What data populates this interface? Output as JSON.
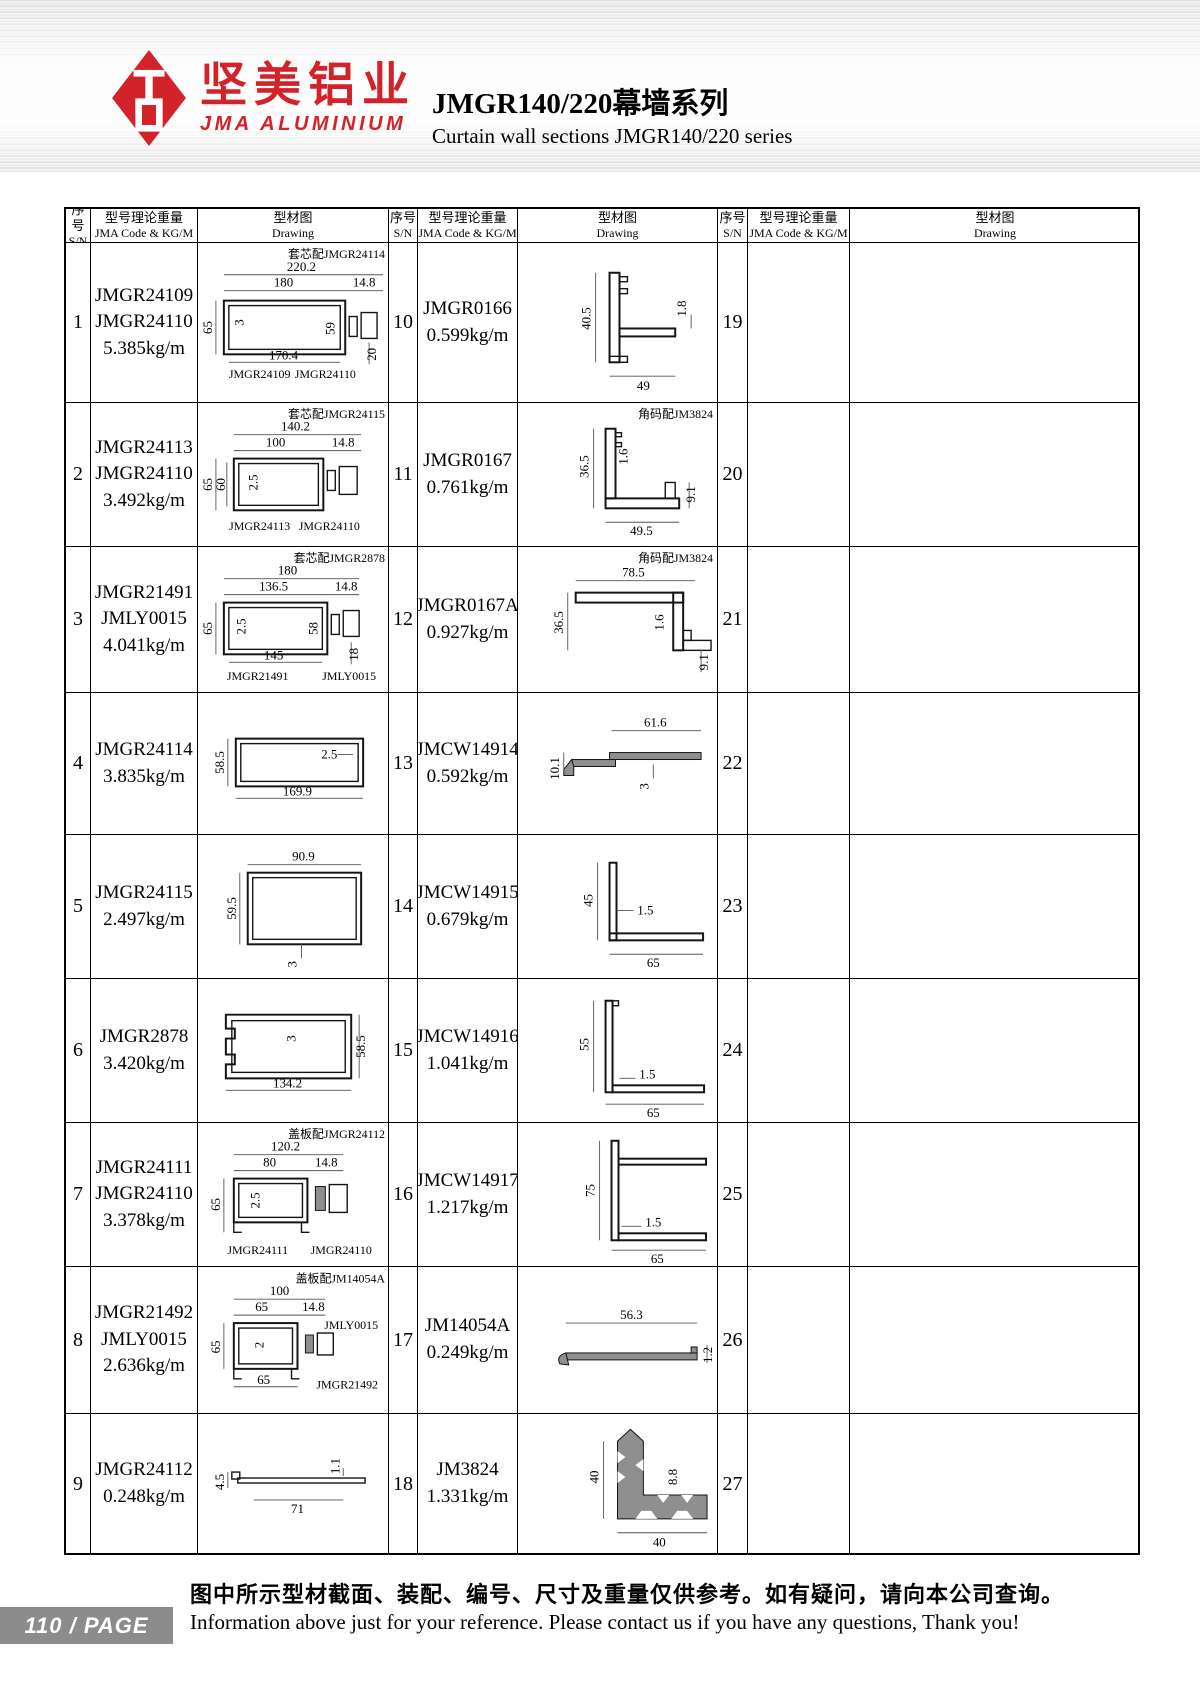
{
  "header": {
    "logo_cn": "坚美铝业",
    "logo_en": "JMA ALUMINIUM",
    "brand_red": "#d2232a",
    "title_cn": "JMGR140/220幕墙系列",
    "title_en": "Curtain wall sections JMGR140/220 series"
  },
  "table_headers": {
    "sn_cn": "序号",
    "sn_en": "S/N",
    "code_cn": "型号理论重量",
    "code_en": "JMA Code & KG/M",
    "drawing_cn": "型材图",
    "drawing_en": "Drawing"
  },
  "col1": [
    {
      "sn": "1",
      "lines": [
        "JMGR24109",
        "JMGR24110",
        "5.385kg/m"
      ],
      "drawing": {
        "assembly": "套芯配JMGR24114",
        "dims": [
          "220.2",
          "180",
          "14.8",
          "65",
          "3",
          "59",
          "170.4",
          "20"
        ],
        "labels": [
          "JMGR24109",
          "JMGR24110"
        ]
      }
    },
    {
      "sn": "2",
      "lines": [
        "JMGR24113",
        "JMGR24110",
        "3.492kg/m"
      ],
      "drawing": {
        "assembly": "套芯配JMGR24115",
        "dims": [
          "140.2",
          "100",
          "14.8",
          "65",
          "60",
          "2.5"
        ],
        "labels": [
          "JMGR24113",
          "JMGR24110"
        ]
      }
    },
    {
      "sn": "3",
      "lines": [
        "JMGR21491",
        "JMLY0015",
        "4.041kg/m"
      ],
      "drawing": {
        "assembly": "套芯配JMGR2878",
        "dims": [
          "180",
          "136.5",
          "14.8",
          "65",
          "2.5",
          "58",
          "145",
          "18"
        ],
        "labels": [
          "JMGR21491",
          "JMLY0015"
        ]
      }
    },
    {
      "sn": "4",
      "lines": [
        "JMGR24114",
        "3.835kg/m"
      ],
      "drawing": {
        "dims": [
          "58.5",
          "2.5",
          "169.9"
        ]
      }
    },
    {
      "sn": "5",
      "lines": [
        "JMGR24115",
        "2.497kg/m"
      ],
      "drawing": {
        "dims": [
          "90.9",
          "59.5",
          "3"
        ]
      }
    },
    {
      "sn": "6",
      "lines": [
        "JMGR2878",
        "3.420kg/m"
      ],
      "drawing": {
        "dims": [
          "3",
          "58.5",
          "134.2"
        ]
      }
    },
    {
      "sn": "7",
      "lines": [
        "JMGR24111",
        "JMGR24110",
        "3.378kg/m"
      ],
      "drawing": {
        "assembly": "盖板配JMGR24112",
        "dims": [
          "120.2",
          "80",
          "14.8",
          "65",
          "2.5"
        ],
        "labels": [
          "JMGR24111",
          "JMGR24110"
        ]
      }
    },
    {
      "sn": "8",
      "lines": [
        "JMGR21492",
        "JMLY0015",
        "2.636kg/m"
      ],
      "drawing": {
        "assembly": "盖板配JM14054A",
        "dims": [
          "100",
          "65",
          "14.8",
          "2",
          "65",
          "65"
        ],
        "labels": [
          "JMLY0015",
          "JMGR21492"
        ]
      }
    },
    {
      "sn": "9",
      "lines": [
        "JMGR24112",
        "0.248kg/m"
      ],
      "drawing": {
        "dims": [
          "4.5",
          "1.1",
          "71"
        ]
      }
    }
  ],
  "col2": [
    {
      "sn": "10",
      "lines": [
        "JMGR0166",
        "0.599kg/m"
      ],
      "drawing": {
        "dims": [
          "40.5",
          "1.8",
          "49"
        ]
      }
    },
    {
      "sn": "11",
      "lines": [
        "JMGR0167",
        "0.761kg/m"
      ],
      "drawing": {
        "assembly": "角码配JM3824",
        "dims": [
          "36.5",
          "1.6",
          "9.1",
          "49.5"
        ]
      }
    },
    {
      "sn": "12",
      "lines": [
        "JMGR0167A",
        "0.927kg/m"
      ],
      "drawing": {
        "assembly": "角码配JM3824",
        "dims": [
          "78.5",
          "36.5",
          "1.6",
          "9.1"
        ]
      }
    },
    {
      "sn": "13",
      "lines": [
        "JMCW14914",
        "0.592kg/m"
      ],
      "drawing": {
        "dims": [
          "61.6",
          "10.1",
          "3"
        ]
      }
    },
    {
      "sn": "14",
      "lines": [
        "JMCW14915",
        "0.679kg/m"
      ],
      "drawing": {
        "dims": [
          "45",
          "1.5",
          "65"
        ]
      }
    },
    {
      "sn": "15",
      "lines": [
        "JMCW14916",
        "1.041kg/m"
      ],
      "drawing": {
        "dims": [
          "55",
          "1.5",
          "65"
        ]
      }
    },
    {
      "sn": "16",
      "lines": [
        "JMCW14917",
        "1.217kg/m"
      ],
      "drawing": {
        "dims": [
          "75",
          "1.5",
          "65"
        ]
      }
    },
    {
      "sn": "17",
      "lines": [
        "JM14054A",
        "0.249kg/m"
      ],
      "drawing": {
        "dims": [
          "56.3",
          "1.2"
        ]
      }
    },
    {
      "sn": "18",
      "lines": [
        "JM3824",
        "1.331kg/m"
      ],
      "drawing": {
        "dims": [
          "40",
          "8.8",
          "40"
        ]
      }
    }
  ],
  "col3": [
    {
      "sn": "19"
    },
    {
      "sn": "20"
    },
    {
      "sn": "21"
    },
    {
      "sn": "22"
    },
    {
      "sn": "23"
    },
    {
      "sn": "24"
    },
    {
      "sn": "25"
    },
    {
      "sn": "26"
    },
    {
      "sn": "27"
    }
  ],
  "footer": {
    "page_badge": "110 / PAGE",
    "note_cn": "图中所示型材截面、装配、编号、尺寸及重量仅供参考。如有疑问，请向本公司查询。",
    "note_en": "Information above just for your reference. Please contact us if you have any questions, Thank you!"
  }
}
